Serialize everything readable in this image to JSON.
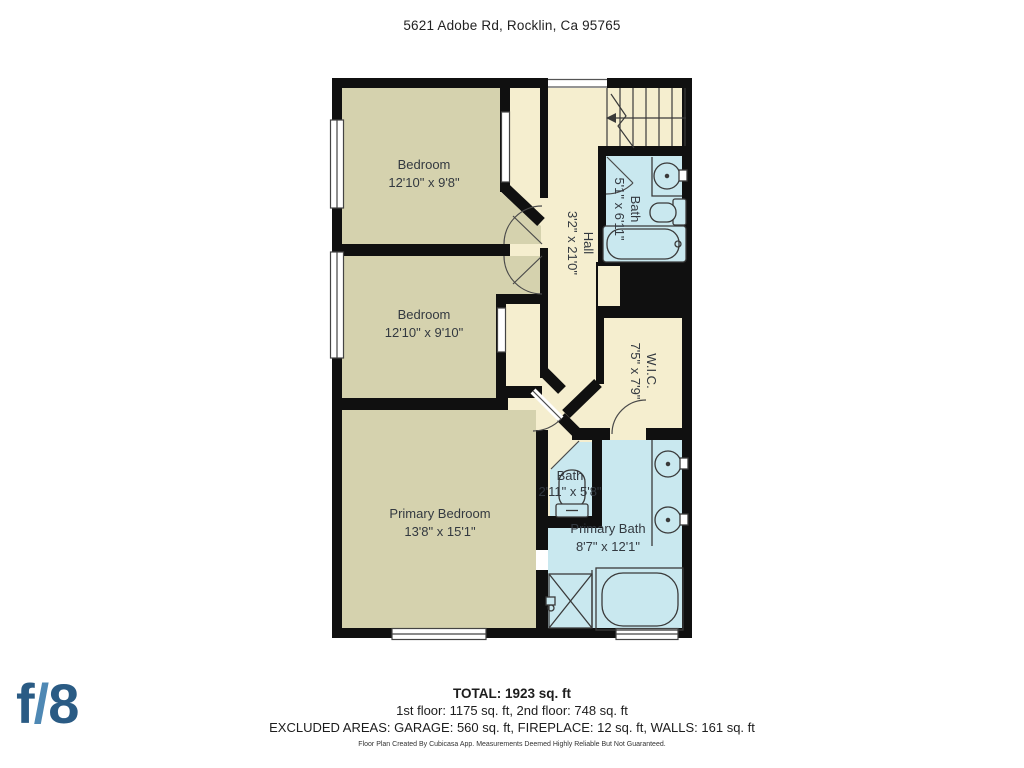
{
  "header": {
    "address": "5621 Adobe Rd, Rocklin, Ca 95765"
  },
  "floorplan": {
    "rooms": [
      {
        "id": "bedroom-1",
        "name": "Bedroom",
        "dims": "12'10\" x 9'8\""
      },
      {
        "id": "bedroom-2",
        "name": "Bedroom",
        "dims": "12'10\" x 9'10\""
      },
      {
        "id": "primary-bedroom",
        "name": "Primary Bedroom",
        "dims": "13'8\" x 15'1\""
      },
      {
        "id": "hall",
        "name": "Hall",
        "dims": "3'2\" x 21'0\""
      },
      {
        "id": "bath-upper",
        "name": "Bath",
        "dims": "5'1\" x 6'11\""
      },
      {
        "id": "wic",
        "name": "W.I.C.",
        "dims": "7'5\" x 7'9\""
      },
      {
        "id": "bath-toilet",
        "name": "Bath",
        "dims": "2'11\" x 5'8\""
      },
      {
        "id": "primary-bath",
        "name": "Primary Bath",
        "dims": "8'7\" x 12'1\""
      }
    ],
    "colors": {
      "wall": "#101010",
      "room_olive": "#d5d2ae",
      "room_cream": "#f5eecf",
      "room_blue": "#c9e8ef",
      "fixture_line": "#3a3a3a"
    }
  },
  "footer": {
    "total": "TOTAL: 1923 sq. ft",
    "floors": "1st floor: 1175 sq. ft, 2nd floor: 748 sq. ft",
    "excluded": "EXCLUDED AREAS: GARAGE: 560 sq. ft, FIREPLACE: 12 sq. ft, WALLS: 161 sq. ft",
    "disclaimer": "Floor Plan Created By Cubicasa App. Measurements Deemed Highly Reliable But Not Guaranteed."
  },
  "logo": {
    "f": "f",
    "slash": "/",
    "eight": "8"
  }
}
